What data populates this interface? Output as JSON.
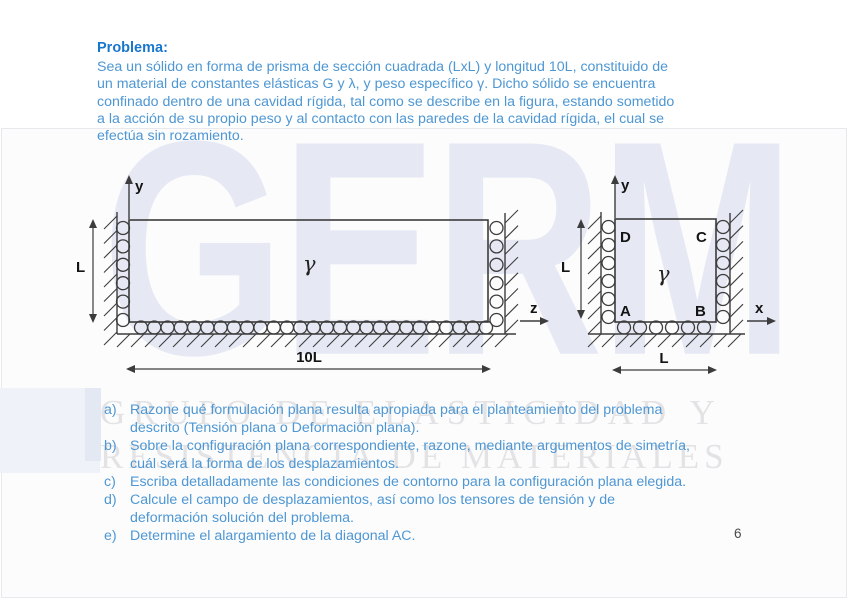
{
  "slide": {
    "title": "Problema:",
    "intro_lines": [
      "Sea un sólido en forma de prisma de sección cuadrada (LxL) y longitud 10L, constituido de",
      "un material de constantes elásticas G y λ, y peso específico γ. Dicho sólido se encuentra",
      "confinado dentro de una cavidad rígida, tal como se describe en la figura, estando sometido",
      "a la acción de su propio peso y al contacto con las paredes de la cavidad rígida, el cual se",
      "efectúa sin rozamiento."
    ],
    "page_number": "6"
  },
  "watermark": {
    "logo_text": "GERM",
    "line1": "GRUPO DE ELASTICIDAD Y",
    "line2": "RESISTENCIA DE MATERIALES"
  },
  "figure": {
    "left": {
      "axis_y": "y",
      "axis_z": "z",
      "gamma": "γ",
      "dim_h": "L",
      "dim_w": "10L"
    },
    "right": {
      "axis_y": "y",
      "axis_x": "x",
      "gamma": "γ",
      "dim_h": "L",
      "dim_w": "L",
      "corner_d": "D",
      "corner_c": "C",
      "corner_a": "A",
      "corner_b": "B"
    }
  },
  "questions": {
    "items": [
      {
        "label": "a)",
        "lines": [
          "Razone qué formulación plana resulta apropiada para el planteamiento del problema",
          "descrito (Tensión plana o Deformación plana)."
        ]
      },
      {
        "label": "b)",
        "lines": [
          "Sobre la configuración plana correspondiente, razone, mediante argumentos de simetría,",
          "cuál será la forma de los desplazamientos."
        ]
      },
      {
        "label": "c)",
        "lines": [
          "Escriba detalladamente las condiciones de contorno para la configuración plana elegida."
        ]
      },
      {
        "label": "d)",
        "lines": [
          "Calcule el campo de desplazamientos, así como los tensores de tensión y de",
          "deformación solución del problema."
        ]
      },
      {
        "label": "e)",
        "lines": [
          "Determine el alargamiento de la diagonal AC."
        ]
      }
    ]
  },
  "colors": {
    "title_blue": "#1876cd",
    "body_blue": "#4e97d3",
    "diagram_stroke": "#3c3c3c",
    "watermark_lavender": "#e6e9f4",
    "watermark_gray": "#e3e3e5"
  }
}
